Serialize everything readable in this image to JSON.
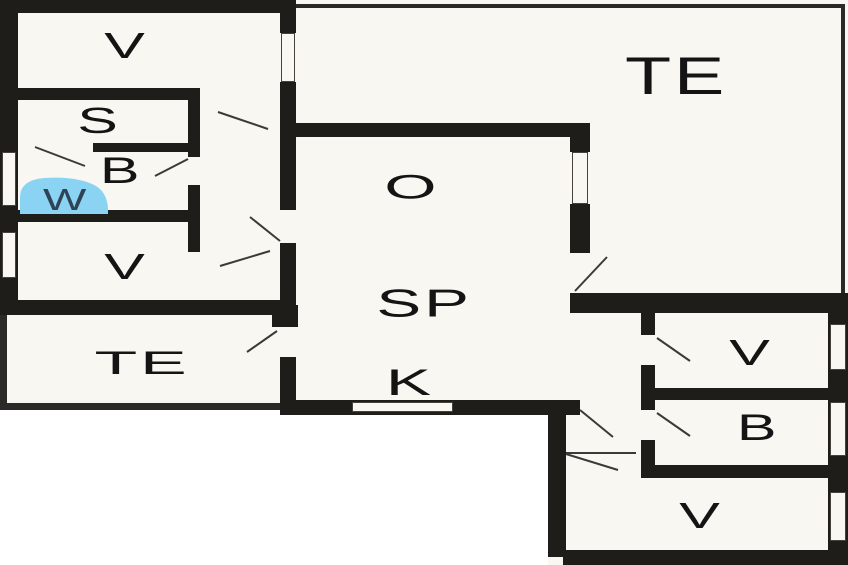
{
  "plan": {
    "rooms": [
      {
        "id": "v-top-left",
        "label": "V"
      },
      {
        "id": "s",
        "label": "S"
      },
      {
        "id": "b-left",
        "label": "B"
      },
      {
        "id": "w",
        "label": "W"
      },
      {
        "id": "v-mid-left",
        "label": "V"
      },
      {
        "id": "te-left",
        "label": "TE"
      },
      {
        "id": "o",
        "label": "O"
      },
      {
        "id": "sp",
        "label": "SP"
      },
      {
        "id": "k",
        "label": "K"
      },
      {
        "id": "te-right",
        "label": "TE"
      },
      {
        "id": "v-right",
        "label": "V"
      },
      {
        "id": "b-right",
        "label": "B"
      },
      {
        "id": "v-bottom-right",
        "label": "V"
      }
    ],
    "colors": {
      "background": "#ffffff",
      "floor": "#f8f7f1",
      "wall": "#1f1d1a",
      "terrace_edge": "#2c2a28",
      "wc_highlight": "#8ad3f3",
      "wc_label": "#2e4356",
      "label": "#141414",
      "door_line": "#3a3a38"
    }
  }
}
